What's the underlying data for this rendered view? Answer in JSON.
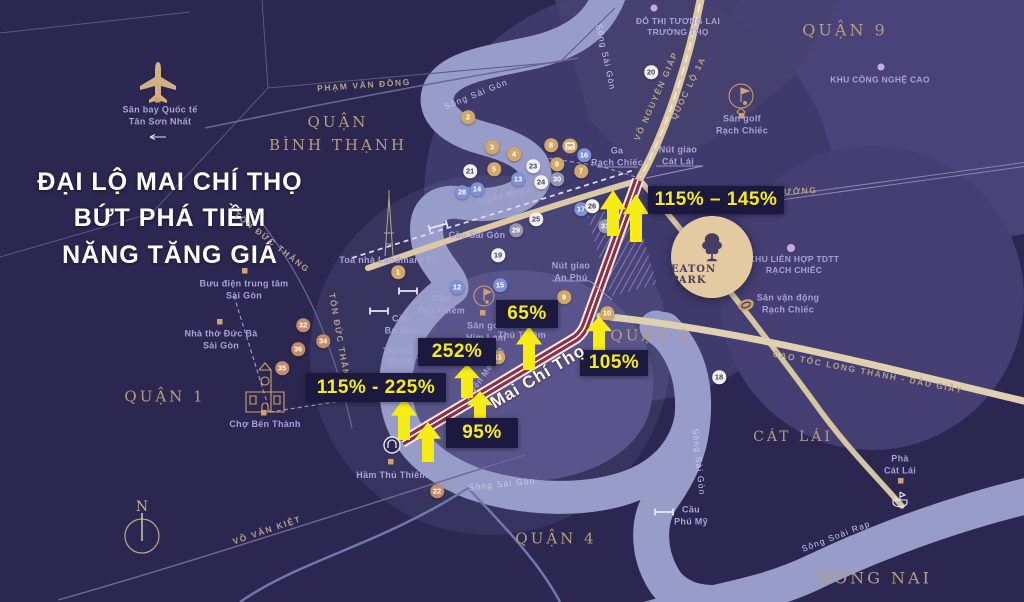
{
  "title": "ĐẠI LỘ MAI CHÍ THỌ\nBỨT PHÁ TIỀM\nNĂNG TĂNG GIÁ",
  "project": {
    "name": "EATON PARK"
  },
  "road_name_highlight": {
    "text": "Mai Chí Thọ"
  },
  "compass_label": "N",
  "colors": {
    "background": "#2b2751",
    "river": "#989cc9",
    "road": "#dcc9a4",
    "highlight_road": "#8e2f44",
    "accent_yellow": "#f8ec15",
    "label_box": "#1c1941",
    "district_text": "#b89d7c",
    "place_text": "#a6a3d6"
  },
  "districts": [
    {
      "label": "QUẬN\nBÌNH THẠNH",
      "x": 338,
      "y": 134,
      "fs": 15
    },
    {
      "label": "QUẬN 9",
      "x": 845,
      "y": 31,
      "fs": 16
    },
    {
      "label": "QUẬN 1",
      "x": 165,
      "y": 397,
      "fs": 15
    },
    {
      "label": "QUẬN 2",
      "x": 651,
      "y": 336,
      "fs": 15
    },
    {
      "label": "QUẬN 4",
      "x": 556,
      "y": 539,
      "fs": 15
    },
    {
      "label": "CÁT LÁI",
      "x": 793,
      "y": 438,
      "fs": 14
    },
    {
      "label": "ĐỒNG NAI",
      "x": 875,
      "y": 579,
      "fs": 16
    }
  ],
  "places": [
    {
      "label": "Sân bay Quốc tế\nTân Sơn Nhất",
      "x": 160,
      "y": 116
    },
    {
      "label": "Toà nhà Landmark 81",
      "x": 388,
      "y": 261
    },
    {
      "label": "Bưu điện trung tâm\nSài Gòn",
      "x": 244,
      "y": 290
    },
    {
      "label": "Nhà thờ Đức Bà\nSài Gòn",
      "x": 221,
      "y": 340
    },
    {
      "label": "Chợ Bến Thành",
      "x": 265,
      "y": 425
    },
    {
      "label": "Hầm Thủ Thiêm",
      "x": 392,
      "y": 476
    },
    {
      "label": "Cầu Sài Gòn",
      "x": 477,
      "y": 236
    },
    {
      "label": "Cầu\nThủ Thiêm",
      "x": 441,
      "y": 305
    },
    {
      "label": "Cầu\nBa Son",
      "x": 401,
      "y": 325
    },
    {
      "label": "Sân golf\nHim Lam",
      "x": 486,
      "y": 332
    },
    {
      "label": "TRUNG TÂM\nQUỐC TẾ",
      "x": 408,
      "y": 357,
      "fs": 8
    },
    {
      "label": "Thủ Thiêm",
      "x": 522,
      "y": 336
    },
    {
      "label": "Ga\nRạch Chiếc",
      "x": 617,
      "y": 157
    },
    {
      "label": "Nút giao\nCát Lái",
      "x": 678,
      "y": 156
    },
    {
      "label": "Nút giao\nAn Phú",
      "x": 571,
      "y": 272
    },
    {
      "label": "ĐÔ THỊ TƯƠNG LAI\nTRƯỜNG THỌ",
      "x": 678,
      "y": 27,
      "fs": 8.5
    },
    {
      "label": "KHU CÔNG NGHỆ CAO",
      "x": 880,
      "y": 80,
      "fs": 8.5
    },
    {
      "label": "Sân golf\nRạch Chiếc",
      "x": 742,
      "y": 125
    },
    {
      "label": "KHU LIÊN HỢP TDTT\nRẠCH CHIẾC",
      "x": 794,
      "y": 265,
      "fs": 8.5
    },
    {
      "label": "Sân vận động\nRạch Chiếc",
      "x": 788,
      "y": 304
    },
    {
      "label": "Cầu\nPhú Mỹ",
      "x": 691,
      "y": 516
    },
    {
      "label": "Phà\nCát Lái",
      "x": 900,
      "y": 465
    }
  ],
  "road_labels": [
    {
      "label": "PHẠM VĂN ĐỒNG",
      "x": 364,
      "y": 85,
      "rot": -4
    },
    {
      "label": "TÔN ĐỨC THẮNG",
      "x": 272,
      "y": 242,
      "rot": 38
    },
    {
      "label": "TÔN ĐỨC THẮNG",
      "x": 340,
      "y": 339,
      "rot": 80
    },
    {
      "label": "VÕ VĂN KIỆT",
      "x": 267,
      "y": 530,
      "rot": -19
    },
    {
      "label": "VÕ NGUYÊN GIÁP",
      "x": 656,
      "y": 96,
      "rot": -66
    },
    {
      "label": "QUỐC LỘ 1A",
      "x": 688,
      "y": 88,
      "rot": -64
    },
    {
      "label": "CAO TỐC LONG THÀNH - DẦU GIÂY",
      "x": 868,
      "y": 372,
      "rot": 11
    },
    {
      "label": "HƯỚNG",
      "x": 797,
      "y": 191,
      "rot": -3
    },
    {
      "label": "Tuyến Metro 1",
      "x": 508,
      "y": 194,
      "rot": -13,
      "c": "metro"
    },
    {
      "label": "Tuyến Metro 2",
      "x": 484,
      "y": 374,
      "rot": -55,
      "c": "metro"
    }
  ],
  "river_labels": [
    {
      "label": "Sông Sài Gòn",
      "x": 476,
      "y": 94,
      "rot": -22
    },
    {
      "label": "Sông Sài Gòn",
      "x": 606,
      "y": 57,
      "rot": 78
    },
    {
      "label": "Sông Sài Gòn",
      "x": 502,
      "y": 484,
      "rot": -6
    },
    {
      "label": "Sông Sài Gòn",
      "x": 699,
      "y": 462,
      "rot": 84
    },
    {
      "label": "Sông Soài Rạp",
      "x": 836,
      "y": 536,
      "rot": -21
    }
  ],
  "percent_labels": [
    {
      "text": "115% – 145%",
      "x": 648,
      "y": 186,
      "w": 136,
      "h": 28
    },
    {
      "text": "65%",
      "x": 496,
      "y": 300,
      "w": 62,
      "h": 28
    },
    {
      "text": "252%",
      "x": 418,
      "y": 338,
      "w": 78,
      "h": 28
    },
    {
      "text": "115% - 225%",
      "x": 306,
      "y": 373,
      "w": 140,
      "h": 29
    },
    {
      "text": "95%",
      "x": 446,
      "y": 418,
      "w": 72,
      "h": 30
    },
    {
      "text": "105%",
      "x": 580,
      "y": 350,
      "w": 68,
      "h": 26
    }
  ],
  "arrows": [
    {
      "x": 613,
      "y": 190,
      "h": 46
    },
    {
      "x": 636,
      "y": 194,
      "h": 48
    },
    {
      "x": 529,
      "y": 326,
      "h": 44
    },
    {
      "x": 467,
      "y": 364,
      "h": 34
    },
    {
      "x": 404,
      "y": 398,
      "h": 42
    },
    {
      "x": 428,
      "y": 422,
      "h": 40
    },
    {
      "x": 480,
      "y": 391,
      "h": 34
    },
    {
      "x": 599,
      "y": 316,
      "h": 36
    }
  ],
  "markers": [
    {
      "n": "1",
      "c": "g",
      "x": 398,
      "y": 272
    },
    {
      "n": "2",
      "c": "g",
      "x": 468,
      "y": 117
    },
    {
      "n": "3",
      "c": "g",
      "x": 492,
      "y": 147
    },
    {
      "n": "4",
      "c": "g",
      "x": 514,
      "y": 154
    },
    {
      "n": "5",
      "c": "g",
      "x": 494,
      "y": 169
    },
    {
      "n": "6",
      "c": "g",
      "x": 557,
      "y": 164
    },
    {
      "n": "7",
      "c": "g",
      "x": 581,
      "y": 171
    },
    {
      "n": "8",
      "c": "g",
      "x": 551,
      "y": 145
    },
    {
      "n": "9",
      "c": "g",
      "x": 564,
      "y": 297
    },
    {
      "n": "10",
      "c": "g",
      "x": 607,
      "y": 313
    },
    {
      "n": "11",
      "c": "g",
      "x": 498,
      "y": 357
    },
    {
      "n": "12",
      "c": "b",
      "x": 457,
      "y": 287
    },
    {
      "n": "13",
      "c": "b",
      "x": 518,
      "y": 179
    },
    {
      "n": "14",
      "c": "b",
      "x": 477,
      "y": 189
    },
    {
      "n": "15",
      "c": "b",
      "x": 500,
      "y": 285
    },
    {
      "n": "16",
      "c": "b",
      "x": 584,
      "y": 155
    },
    {
      "n": "17",
      "c": "b",
      "x": 581,
      "y": 209
    },
    {
      "n": "18",
      "c": "w",
      "x": 719,
      "y": 377
    },
    {
      "n": "19",
      "c": "w",
      "x": 498,
      "y": 255
    },
    {
      "n": "20",
      "c": "w",
      "x": 651,
      "y": 72
    },
    {
      "n": "21",
      "c": "w",
      "x": 470,
      "y": 171
    },
    {
      "n": "22",
      "c": "s",
      "x": 437,
      "y": 491
    },
    {
      "n": "23",
      "c": "w",
      "x": 533,
      "y": 166
    },
    {
      "n": "24",
      "c": "w",
      "x": 541,
      "y": 182
    },
    {
      "n": "25",
      "c": "w",
      "x": 536,
      "y": 219
    },
    {
      "n": "26",
      "c": "w",
      "x": 592,
      "y": 206
    },
    {
      "n": "28",
      "c": "b",
      "x": 462,
      "y": 192
    },
    {
      "n": "29",
      "c": "y",
      "x": 516,
      "y": 230
    },
    {
      "n": "30",
      "c": "y",
      "x": 557,
      "y": 179
    },
    {
      "n": "31",
      "c": "y",
      "x": 605,
      "y": 226
    },
    {
      "n": "32",
      "c": "s",
      "x": 303,
      "y": 325
    },
    {
      "n": "34",
      "c": "s",
      "x": 323,
      "y": 341
    },
    {
      "n": "35",
      "c": "s",
      "x": 282,
      "y": 368
    },
    {
      "n": "36",
      "c": "s",
      "x": 298,
      "y": 349
    }
  ]
}
